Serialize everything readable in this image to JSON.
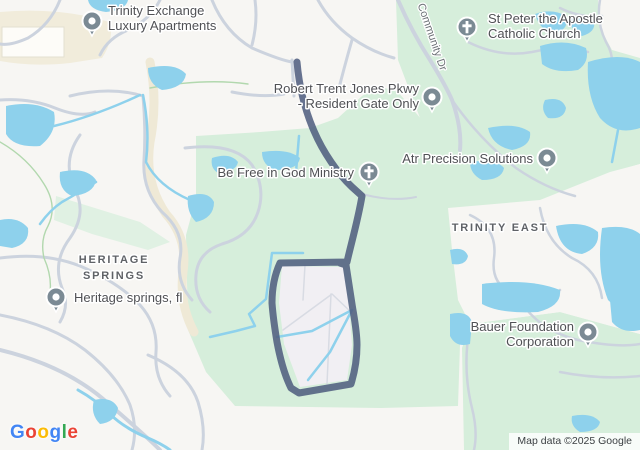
{
  "map": {
    "pois": [
      {
        "name": "trinity-exchange",
        "line1": "Trinity Exchange",
        "line2": "Luxury Apartments",
        "glyph": "dot"
      },
      {
        "name": "st-peter",
        "line1": "St Peter the Apostle",
        "line2": "Catholic Church",
        "glyph": "cross"
      },
      {
        "name": "robert-trent-jones",
        "line1": "Robert Trent Jones Pkwy",
        "line2": "- Resident Gate Only",
        "glyph": "dot"
      },
      {
        "name": "be-free-ministry",
        "line1": "Be Free in God Ministry",
        "line2": "",
        "glyph": "cross"
      },
      {
        "name": "atr-precision",
        "line1": "Atr Precision Solutions",
        "line2": "",
        "glyph": "dot"
      },
      {
        "name": "heritage-springs-fl",
        "line1": "Heritage springs, fl",
        "line2": "",
        "glyph": "dot"
      },
      {
        "name": "bauer-foundation",
        "line1": "Bauer Foundation",
        "line2": "Corporation",
        "glyph": "dot"
      }
    ],
    "area_labels": {
      "trinity_east": "TRINITY EAST",
      "heritage_line1": "HERITAGE",
      "heritage_line2": "SPRINGS"
    },
    "road_labels": {
      "community_dr": "Community Dr"
    },
    "logo": {
      "letters": [
        "G",
        "o",
        "o",
        "g",
        "l",
        "e"
      ],
      "colors": [
        "#4285F4",
        "#EA4335",
        "#FBBC05",
        "#4285F4",
        "#34A853",
        "#EA4335"
      ]
    },
    "attribution": "Map data ©2025 Google",
    "colors": {
      "background": "#f7f6f3",
      "green": "#d6eedb",
      "green_pale": "#e0f1e3",
      "water": "#8ed1ec",
      "road": "#ccd3de",
      "trail": "#b2d8ae",
      "commercial": "#f1ecdb",
      "route": "#4c5a7d",
      "pin": "#7b8a94",
      "loop_interior": "#f1eff3"
    }
  }
}
